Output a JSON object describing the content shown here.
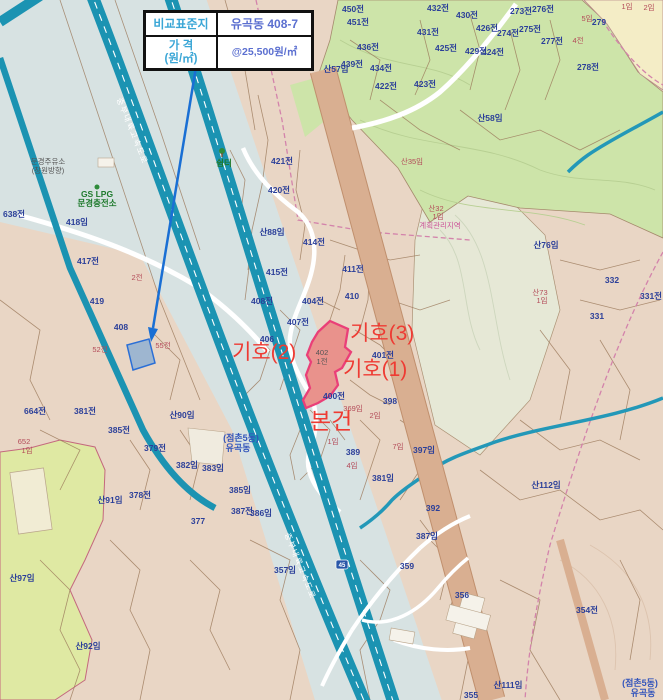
{
  "info_table": {
    "rows": [
      {
        "label": "비교표준지",
        "value": "유곡동 408-7"
      },
      {
        "label_line1": "가 격",
        "label_line2": "(원/㎡)",
        "value": "@25,500원/㎡"
      }
    ]
  },
  "annotations": {
    "symbol3": "기호(3)",
    "symbol2": "기호(2)",
    "symbol1": "기호(1)",
    "subject": "본건",
    "color": "#ee3b33"
  },
  "map": {
    "road_name": "중부내륙고속도로",
    "shield": "45",
    "colors": {
      "base_tan": "#e9d6c5",
      "forest_green": "#cde4a9",
      "cream": "#f4edc6",
      "yellow_green": "#dfe9a3",
      "expressway_teal": "#1b93b2",
      "corridor_gray": "#d7e2e2",
      "rail_brown": "#d9af91",
      "highlight_parcel_stroke": "#ea3f78",
      "highlight_parcel_fill": "#e9928c",
      "comp_parcel_blue": "#2b6fd6",
      "annotation_red": "#ee3b33",
      "label_blue": "#2b3f99",
      "label_red": "#b34a58",
      "zoning_magenta": "#cc5599"
    },
    "parcel_labels": [
      {
        "t": "450전",
        "x": 353,
        "y": 12
      },
      {
        "t": "451전",
        "x": 358,
        "y": 25
      },
      {
        "t": "432전",
        "x": 438,
        "y": 11
      },
      {
        "t": "431전",
        "x": 428,
        "y": 35
      },
      {
        "t": "430전",
        "x": 467,
        "y": 18
      },
      {
        "t": "426전",
        "x": 487,
        "y": 31
      },
      {
        "t": "436전",
        "x": 368,
        "y": 50
      },
      {
        "t": "425전",
        "x": 446,
        "y": 51
      },
      {
        "t": "429전",
        "x": 476,
        "y": 54
      },
      {
        "t": "424전",
        "x": 493,
        "y": 55
      },
      {
        "t": "439전",
        "x": 352,
        "y": 67
      },
      {
        "t": "434전",
        "x": 381,
        "y": 71
      },
      {
        "t": "422전",
        "x": 386,
        "y": 89
      },
      {
        "t": "423전",
        "x": 425,
        "y": 87
      },
      {
        "t": "273전",
        "x": 521,
        "y": 14
      },
      {
        "t": "275전",
        "x": 530,
        "y": 32
      },
      {
        "t": "274전",
        "x": 508,
        "y": 36
      },
      {
        "t": "276전",
        "x": 543,
        "y": 12
      },
      {
        "t": "277전",
        "x": 552,
        "y": 44
      },
      {
        "t": "278전",
        "x": 588,
        "y": 70
      },
      {
        "t": "279",
        "x": 599,
        "y": 25
      },
      {
        "t": "산57임",
        "x": 336,
        "y": 72
      },
      {
        "t": "산58임",
        "x": 490,
        "y": 121,
        "s": 10
      },
      {
        "t": "5임",
        "x": 587,
        "y": 21,
        "c": "r"
      },
      {
        "t": "1임",
        "x": 627,
        "y": 9,
        "c": "r"
      },
      {
        "t": "2임",
        "x": 649,
        "y": 10,
        "c": "r"
      },
      {
        "t": "4전",
        "x": 578,
        "y": 43,
        "c": "r"
      },
      {
        "t": "산35임",
        "x": 412,
        "y": 164,
        "c": "r"
      },
      {
        "t": "421전",
        "x": 282,
        "y": 164
      },
      {
        "t": "420전",
        "x": 279,
        "y": 193
      },
      {
        "t": "산88임",
        "x": 272,
        "y": 235
      },
      {
        "t": "414전",
        "x": 314,
        "y": 245
      },
      {
        "t": "415전",
        "x": 277,
        "y": 275
      },
      {
        "t": "411전",
        "x": 353,
        "y": 272
      },
      {
        "t": "410",
        "x": 352,
        "y": 299
      },
      {
        "t": "404전",
        "x": 313,
        "y": 304
      },
      {
        "t": "408전",
        "x": 262,
        "y": 304
      },
      {
        "t": "407전",
        "x": 298,
        "y": 325
      },
      {
        "t": "406",
        "x": 267,
        "y": 342
      },
      {
        "t": "401전",
        "x": 383,
        "y": 358
      },
      {
        "t": "400전",
        "x": 334,
        "y": 399
      },
      {
        "t": "398",
        "x": 390,
        "y": 404
      },
      {
        "t": "369임",
        "x": 353,
        "y": 411,
        "c": "r"
      },
      {
        "t": "2임",
        "x": 375,
        "y": 418,
        "c": "r"
      },
      {
        "t": "1임",
        "x": 333,
        "y": 444,
        "c": "r"
      },
      {
        "t": "7임",
        "x": 398,
        "y": 449,
        "c": "r"
      },
      {
        "t": "4임",
        "x": 352,
        "y": 468,
        "c": "r"
      },
      {
        "t": "389",
        "x": 353,
        "y": 455
      },
      {
        "t": "397임",
        "x": 424,
        "y": 453
      },
      {
        "t": "381임",
        "x": 383,
        "y": 481
      },
      {
        "t": "392",
        "x": 433,
        "y": 511
      },
      {
        "t": "387임",
        "x": 427,
        "y": 539
      },
      {
        "t": "359",
        "x": 407,
        "y": 569
      },
      {
        "t": "357임",
        "x": 285,
        "y": 573
      },
      {
        "t": "385임",
        "x": 240,
        "y": 493
      },
      {
        "t": "387전",
        "x": 242,
        "y": 514
      },
      {
        "t": "386임",
        "x": 261,
        "y": 516
      },
      {
        "t": "402",
        "x": 322,
        "y": 355,
        "c": "d"
      },
      {
        "t": "1전",
        "x": 322,
        "y": 364,
        "c": "d"
      },
      {
        "t": "418임",
        "x": 77,
        "y": 225
      },
      {
        "t": "417전",
        "x": 88,
        "y": 264
      },
      {
        "t": "638전",
        "x": 14,
        "y": 217
      },
      {
        "t": "2전",
        "x": 137,
        "y": 280,
        "c": "r"
      },
      {
        "t": "419",
        "x": 97,
        "y": 304
      },
      {
        "t": "408",
        "x": 121,
        "y": 330,
        "s": 11
      },
      {
        "t": "52전",
        "x": 100,
        "y": 352,
        "c": "r"
      },
      {
        "t": "55전",
        "x": 163,
        "y": 348,
        "c": "r"
      },
      {
        "t": "664전",
        "x": 35,
        "y": 414
      },
      {
        "t": "381전",
        "x": 85,
        "y": 414
      },
      {
        "t": "385전",
        "x": 119,
        "y": 433
      },
      {
        "t": "산90임",
        "x": 182,
        "y": 418
      },
      {
        "t": "379전",
        "x": 155,
        "y": 451
      },
      {
        "t": "382임",
        "x": 187,
        "y": 468
      },
      {
        "t": "383임",
        "x": 213,
        "y": 471
      },
      {
        "t": "378전",
        "x": 140,
        "y": 498
      },
      {
        "t": "산91임",
        "x": 110,
        "y": 503
      },
      {
        "t": "377",
        "x": 198,
        "y": 524
      },
      {
        "t": "652",
        "x": 24,
        "y": 444,
        "c": "r"
      },
      {
        "t": "1임",
        "x": 27,
        "y": 453,
        "c": "r"
      },
      {
        "t": "산97임",
        "x": 22,
        "y": 581
      },
      {
        "t": "산92임",
        "x": 88,
        "y": 649
      },
      {
        "t": "산76임",
        "x": 546,
        "y": 248
      },
      {
        "t": "332",
        "x": 612,
        "y": 283
      },
      {
        "t": "331전",
        "x": 651,
        "y": 299
      },
      {
        "t": "331",
        "x": 597,
        "y": 319
      },
      {
        "t": "산73",
        "x": 540,
        "y": 295,
        "c": "r"
      },
      {
        "t": "1임",
        "x": 542,
        "y": 303,
        "c": "r"
      },
      {
        "t": "산32",
        "x": 436,
        "y": 211,
        "c": "r"
      },
      {
        "t": "1임",
        "x": 438,
        "y": 219,
        "c": "r"
      },
      {
        "t": "계획관리지역",
        "x": 440,
        "y": 228,
        "c": "m"
      },
      {
        "t": "산112임",
        "x": 546,
        "y": 488
      },
      {
        "t": "356",
        "x": 462,
        "y": 598
      },
      {
        "t": "354전",
        "x": 587,
        "y": 613
      },
      {
        "t": "산111임",
        "x": 508,
        "y": 688
      },
      {
        "t": "355",
        "x": 471,
        "y": 698
      },
      {
        "t": "(점촌5동)",
        "x": 241,
        "y": 441,
        "c": "a"
      },
      {
        "t": "유곡동",
        "x": 238,
        "y": 451,
        "c": "a"
      },
      {
        "t": "(점촌5동)",
        "x": 640,
        "y": 686,
        "c": "a"
      },
      {
        "t": "유곡동",
        "x": 643,
        "y": 696,
        "c": "a"
      },
      {
        "t": "쉼터",
        "x": 224,
        "y": 166,
        "c": "g"
      },
      {
        "t": "GS LPG",
        "x": 97,
        "y": 197,
        "c": "g"
      },
      {
        "t": "문경충전소",
        "x": 97,
        "y": 206,
        "c": "g"
      },
      {
        "t": "문경주유소",
        "x": 48,
        "y": 164,
        "c": "d"
      },
      {
        "t": "(창원방향)",
        "x": 48,
        "y": 173,
        "c": "d"
      }
    ]
  }
}
